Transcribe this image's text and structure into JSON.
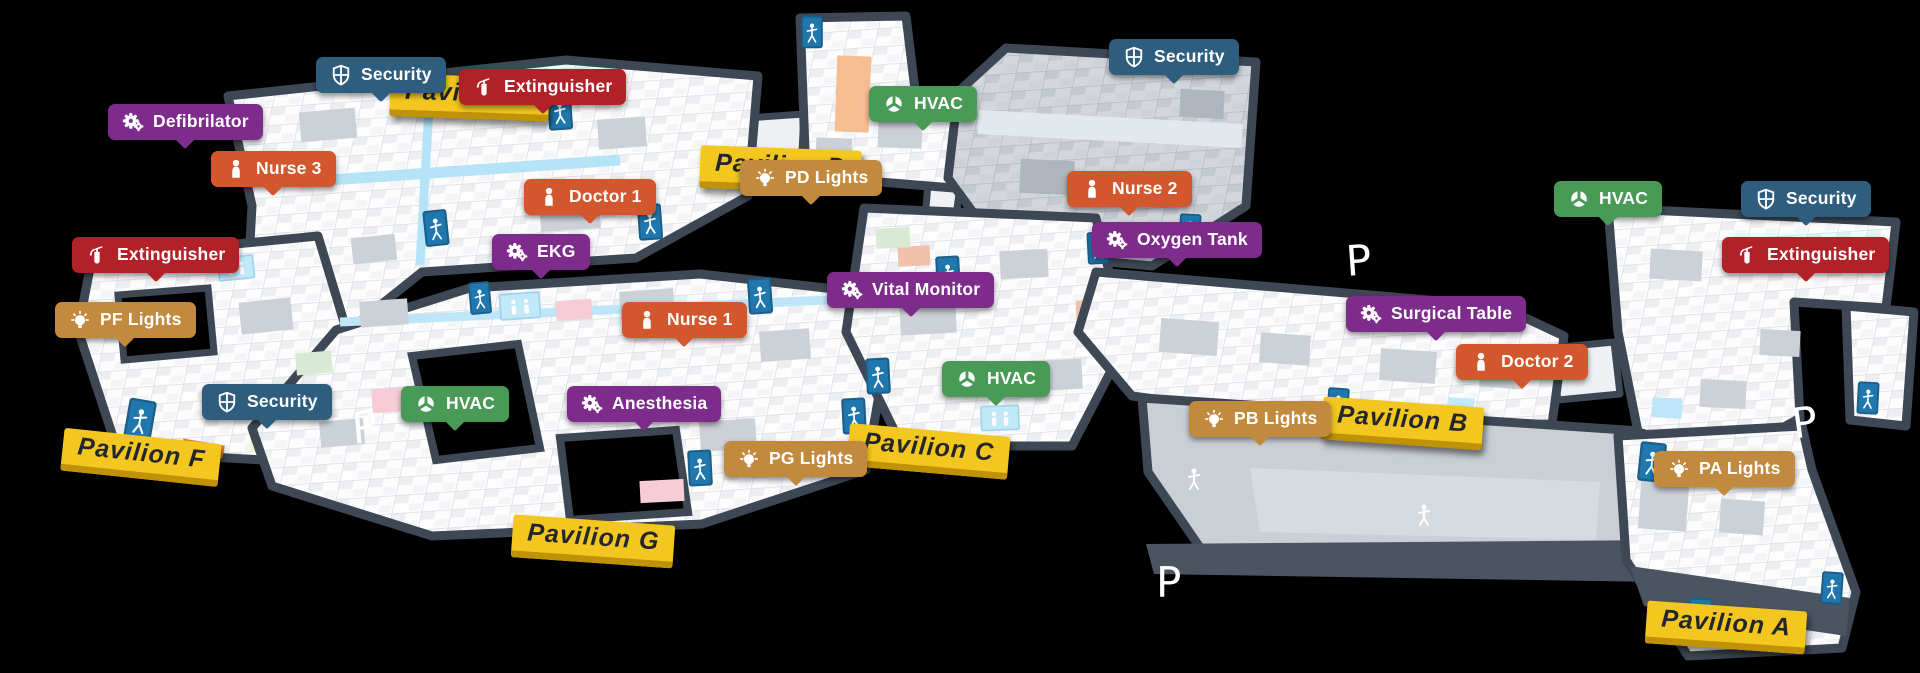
{
  "scene": {
    "description": "Isometric hospital campus floor map with asset markers",
    "background": "#000000"
  },
  "colors": {
    "security": "#2e5d7d",
    "staff": "#d2572d",
    "equipment": "#7d2c8b",
    "lights": "#c28a3e",
    "hvac": "#4a9a57",
    "extinguisher": "#b22127",
    "banner": "#f3c71f",
    "banner_edge": "#bf920a",
    "wall": "#3e4754"
  },
  "markers": [
    {
      "label": "Security",
      "category": "security",
      "icon": "shield-icon"
    },
    {
      "label": "Extinguisher",
      "category": "extinguisher",
      "icon": "fire-extinguisher-icon"
    },
    {
      "label": "Defibrilator",
      "category": "equipment",
      "icon": "gears-icon"
    },
    {
      "label": "Nurse 3",
      "category": "staff",
      "icon": "person-icon"
    },
    {
      "label": "Doctor 1",
      "category": "staff",
      "icon": "person-icon"
    },
    {
      "label": "EKG",
      "category": "equipment",
      "icon": "gears-icon"
    },
    {
      "label": "PD Lights",
      "category": "lights",
      "icon": "lightbulb-icon"
    },
    {
      "label": "Nurse 1",
      "category": "staff",
      "icon": "person-icon"
    },
    {
      "label": "Extinguisher",
      "category": "extinguisher",
      "icon": "fire-extinguisher-icon"
    },
    {
      "label": "PF Lights",
      "category": "lights",
      "icon": "lightbulb-icon"
    },
    {
      "label": "Security",
      "category": "security",
      "icon": "shield-icon"
    },
    {
      "label": "HVAC",
      "category": "hvac",
      "icon": "fan-icon"
    },
    {
      "label": "Anesthesia",
      "category": "equipment",
      "icon": "gears-icon"
    },
    {
      "label": "PG Lights",
      "category": "lights",
      "icon": "lightbulb-icon"
    },
    {
      "label": "Vital Monitor",
      "category": "equipment",
      "icon": "gears-icon"
    },
    {
      "label": "HVAC",
      "category": "hvac",
      "icon": "fan-icon"
    },
    {
      "label": "HVAC",
      "category": "hvac",
      "icon": "fan-icon"
    },
    {
      "label": "Security",
      "category": "security",
      "icon": "shield-icon"
    },
    {
      "label": "Nurse 2",
      "category": "staff",
      "icon": "person-icon"
    },
    {
      "label": "Oxygen Tank",
      "category": "equipment",
      "icon": "gears-icon"
    },
    {
      "label": "Surgical Table",
      "category": "equipment",
      "icon": "gears-icon"
    },
    {
      "label": "Doctor 2",
      "category": "staff",
      "icon": "person-icon"
    },
    {
      "label": "PB Lights",
      "category": "lights",
      "icon": "lightbulb-icon"
    },
    {
      "label": "HVAC",
      "category": "hvac",
      "icon": "fan-icon"
    },
    {
      "label": "Security",
      "category": "security",
      "icon": "shield-icon"
    },
    {
      "label": "Extinguisher",
      "category": "extinguisher",
      "icon": "fire-extinguisher-icon"
    },
    {
      "label": "PA Lights",
      "category": "lights",
      "icon": "lightbulb-icon"
    }
  ],
  "pavilions": [
    {
      "label": "Pavilion A"
    },
    {
      "label": "Pavilion B"
    },
    {
      "label": "Pavilion C"
    },
    {
      "label": "Pavilion D"
    },
    {
      "label": "Pavilion E"
    },
    {
      "label": "Pavilion F"
    },
    {
      "label": "Pavilion G"
    }
  ],
  "parking": [
    "P",
    "P",
    "P",
    "P"
  ]
}
